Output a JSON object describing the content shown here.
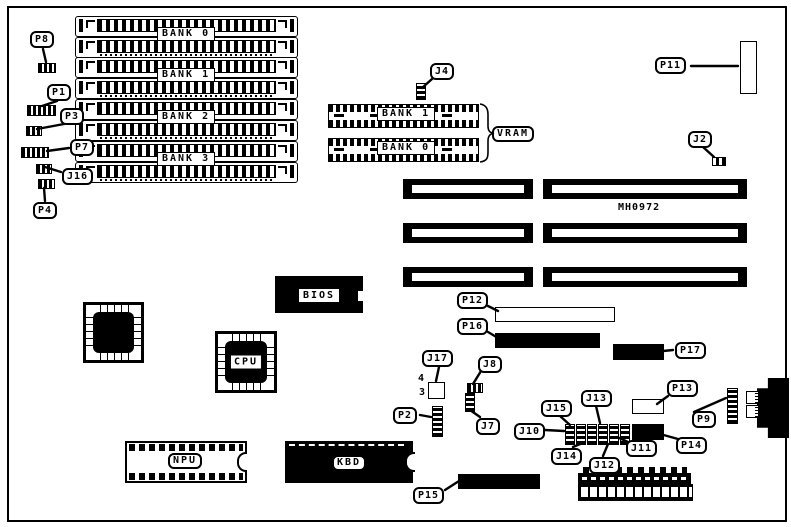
{
  "board": {
    "part_number": "MH0972"
  },
  "memory_banks": [
    {
      "label": "BANK 0"
    },
    {
      "label": "BANK 1"
    },
    {
      "label": "BANK 2"
    },
    {
      "label": "BANK 3"
    }
  ],
  "vram": {
    "label": "VRAM",
    "top_bank": "BANK 1",
    "bottom_bank": "BANK 0"
  },
  "chips": {
    "bios": "BIOS",
    "cpu": "CPU",
    "npu": "NPU",
    "kbd": "KBD"
  },
  "callouts": {
    "p1": "P1",
    "p2": "P2",
    "p3": "P3",
    "p4": "P4",
    "p7": "P7",
    "p8": "P8",
    "p9": "P9",
    "p11": "P11",
    "p12": "P12",
    "p13": "P13",
    "p14": "P14",
    "p15": "P15",
    "p16": "P16",
    "p17": "P17",
    "j2": "J2",
    "j4": "J4",
    "j7": "J7",
    "j8": "J8",
    "j10": "J10",
    "j11": "J11",
    "j12": "J12",
    "j13": "J13",
    "j14": "J14",
    "j15": "J15",
    "j16": "J16",
    "j17": "J17"
  },
  "j17_pin_labels": {
    "pin4": "4",
    "pin3": "3"
  }
}
